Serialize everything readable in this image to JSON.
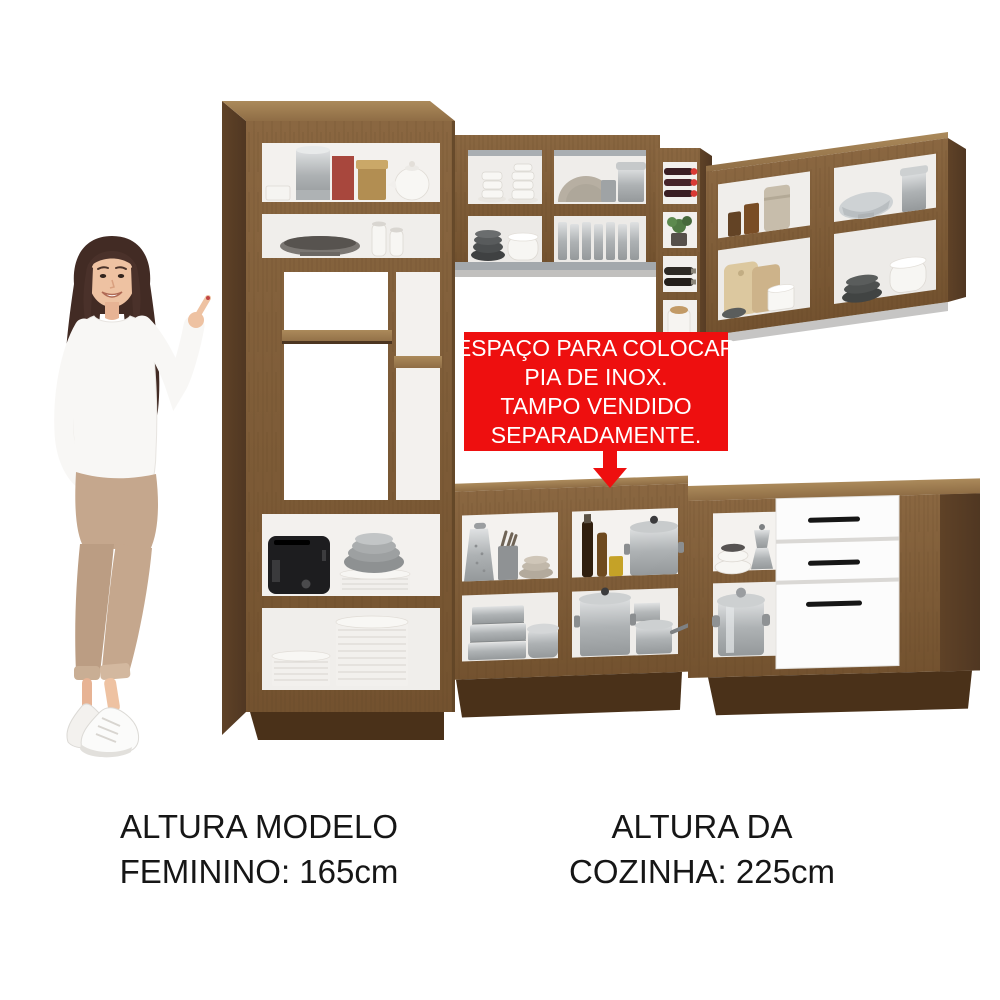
{
  "page": {
    "background": "#ffffff",
    "type": "furniture product image"
  },
  "callout": {
    "lines": [
      "ESPAÇO PARA COLOCAR",
      "PIA DE INOX.",
      "TAMPO VENDIDO",
      "SEPARADAMENTE."
    ],
    "bg_color": "#ee0f0f",
    "text_color": "#ffffff",
    "arrow_color": "#ee0f0f",
    "arrow_direction": "down"
  },
  "captions": {
    "left": {
      "line1": "ALTURA MODELO",
      "line2": "FEMININO: 165cm"
    },
    "right": {
      "line1": "ALTURA DA",
      "line2": "COZINHA: 225cm"
    },
    "text_color": "#161616"
  },
  "scene": {
    "model": {
      "description": "woman with long dark hair pointing at the kitchen",
      "hair_color": "#422b24",
      "skin_color": "#eec2a2",
      "sweater_color": "#f8f7f5",
      "pants_color": "#c5a78d",
      "shoes": "white sneakers"
    },
    "kitchen": {
      "wood_color": "#7d5a39",
      "drawer_front_color": "#fcfcfc",
      "handle_color": "#161616",
      "tall_cabinet": {
        "shelf_items": [
          [
            "white dish",
            "silver canister",
            "red box",
            "gold tin",
            "white teapot"
          ],
          [
            "metal bowl",
            "two white jars"
          ],
          [
            "open empty shelves"
          ],
          [
            "black toaster",
            "gray nested bowls on white plates"
          ],
          [
            "small plate stack",
            "tall plate stack"
          ]
        ]
      },
      "upper_cabinet_middle": {
        "shelf_items": [
          [
            "white cup and saucer stacks",
            "beige bowls",
            "gray canisters"
          ],
          [
            "dark bowl stack",
            "white bowl stack",
            "row of glasses"
          ]
        ]
      },
      "wine_rack": {
        "cubby_items": [
          "wine bottles with red caps",
          "small plant",
          "lying dark bottles",
          "white jar with cork"
        ]
      },
      "upper_cabinet_right": {
        "shelf_items": [
          [
            "amber glass jars",
            "beige jar",
            "decorative gray bowl",
            "silver canisters"
          ],
          [
            "cutting boards",
            "white cups",
            "small dark bowl",
            "dark bowl stack",
            "white bowl stack"
          ]
        ]
      },
      "base_cabinet_middle": {
        "shelf_items": [
          [
            "metal grater",
            "utensil crock",
            "beige bowls",
            "oil bottles",
            "large lidded pot"
          ],
          [
            "stacked steamer pans",
            "oval roaster",
            "stock pot",
            "saucepan"
          ]
        ]
      },
      "base_cabinet_corner": {
        "shelf_items": [
          [
            "white bowl stack",
            "coffee percolator"
          ],
          [
            "large silver pot"
          ]
        ],
        "drawers": 3
      }
    }
  }
}
